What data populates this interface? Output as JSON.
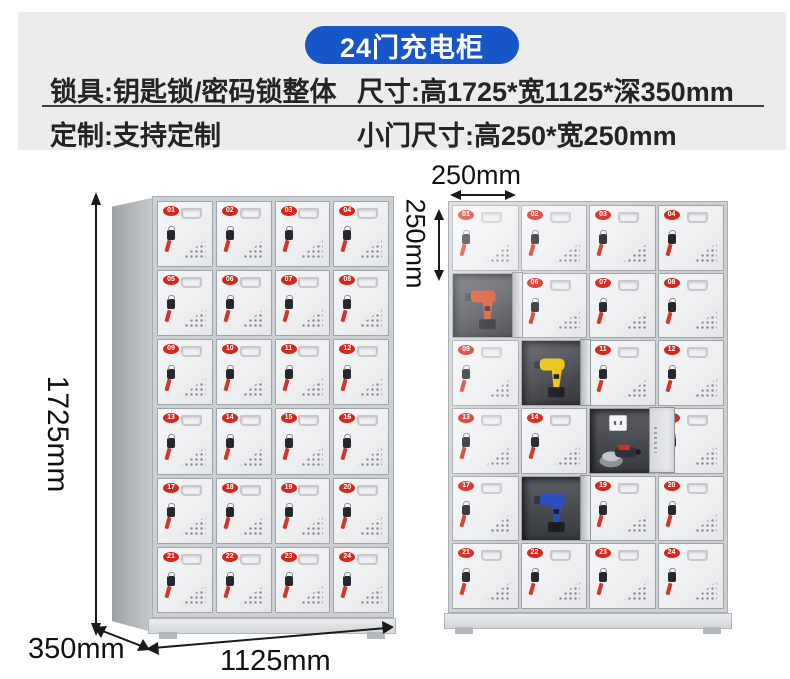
{
  "title": "24门充电柜",
  "specs": {
    "lock": "锁具:钥匙锁/密码锁整体",
    "size": "尺寸:高1725*宽1125*深350mm",
    "custom": "定制:支持定制",
    "door_size": "小门尺寸:高250*宽250mm"
  },
  "dimensions": {
    "height": "1725mm",
    "depth": "350mm",
    "width": "1125mm",
    "door_width": "250mm",
    "door_height": "250mm"
  },
  "colors": {
    "banner_blue": "#1656c8",
    "badge_red": "#d5271d",
    "cabinet_gray": "#eceef0",
    "interior_dark": "#3a3d41"
  },
  "left_cabinet": {
    "doors": [
      "01",
      "02",
      "03",
      "04",
      "05",
      "06",
      "07",
      "08",
      "09",
      "10",
      "11",
      "12",
      "13",
      "14",
      "15",
      "16",
      "17",
      "18",
      "19",
      "20",
      "21",
      "22",
      "23",
      "24"
    ]
  },
  "right_cabinet": {
    "doors": [
      {
        "n": "01"
      },
      {
        "n": "02"
      },
      {
        "n": "03"
      },
      {
        "n": "04"
      },
      {
        "n": "05",
        "open": true,
        "tool": "drill",
        "tool_color": "#d64a1e"
      },
      {
        "n": "06"
      },
      {
        "n": "07"
      },
      {
        "n": "08"
      },
      {
        "n": "09"
      },
      {
        "n": "10",
        "open": true,
        "tool": "drill",
        "tool_color": "#edc414"
      },
      {
        "n": "11"
      },
      {
        "n": "12"
      },
      {
        "n": "13"
      },
      {
        "n": "14"
      },
      {
        "n": "15",
        "open": true,
        "tool": "grinder",
        "tool_color": "#c83529",
        "socket": true
      },
      {
        "n": "16"
      },
      {
        "n": "17"
      },
      {
        "n": "18",
        "open": true,
        "tool": "drill",
        "tool_color": "#2b4fc0"
      },
      {
        "n": "19"
      },
      {
        "n": "20"
      },
      {
        "n": "21"
      },
      {
        "n": "22"
      },
      {
        "n": "23"
      },
      {
        "n": "24"
      }
    ]
  }
}
